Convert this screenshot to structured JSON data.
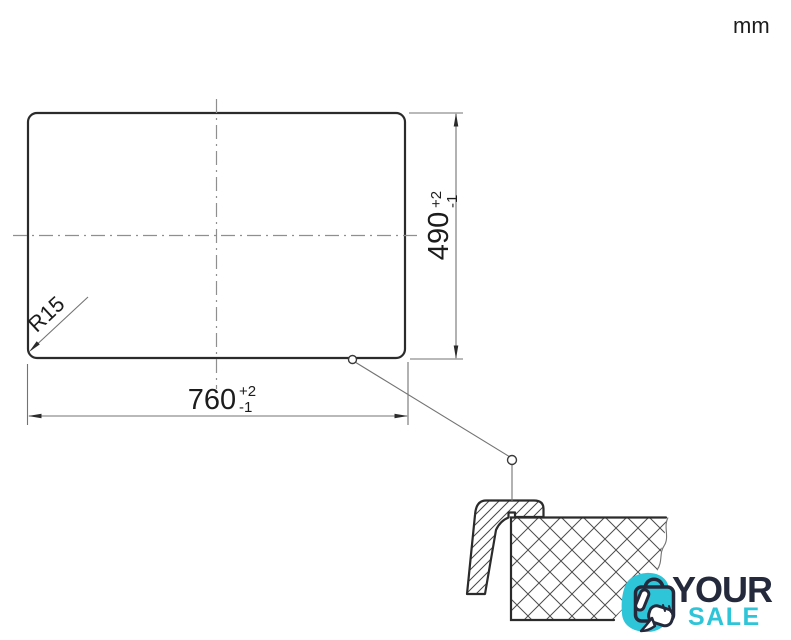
{
  "unit_label": "mm",
  "plan": {
    "description": "sink cutout plan view",
    "width_dimension": {
      "value": "760",
      "tolerance_plus": "+2",
      "tolerance_minus": "-1"
    },
    "height_dimension": {
      "value": "490",
      "tolerance_plus": "+2",
      "tolerance_minus": "-1"
    },
    "corner_radius": "R15"
  },
  "section": {
    "description": "edge cross-section detail of sink rim on countertop"
  },
  "logo": {
    "word_top": "YOUR",
    "word_bottom": "SALE"
  },
  "colors": {
    "background": "#ffffff",
    "line_dark": "#2b2b2b",
    "line_thin": "#737373",
    "centerline": "#8f8f8f",
    "text": "#1c1c1c",
    "logo_dark": "#242a3c",
    "logo_teal": "#2fc5d8"
  }
}
